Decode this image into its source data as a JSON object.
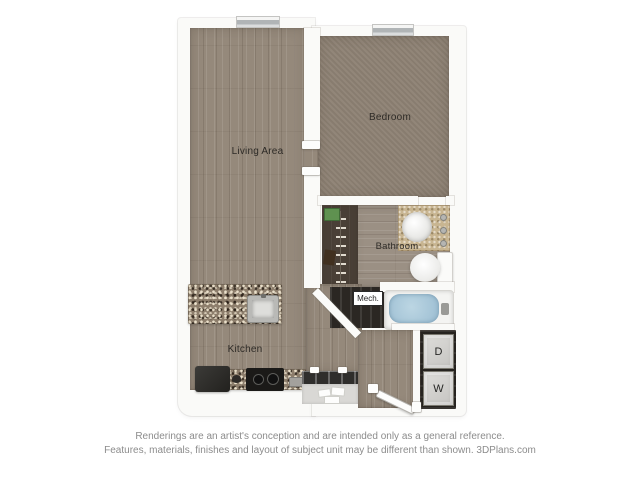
{
  "plan": {
    "rooms": {
      "living": {
        "label": "Living Area"
      },
      "bedroom": {
        "label": "Bedroom"
      },
      "bathroom": {
        "label": "Bathroom"
      },
      "kitchen": {
        "label": "Kitchen"
      },
      "mech": {
        "label": "Mech."
      }
    },
    "laundry": {
      "dryer": {
        "label": "D"
      },
      "washer": {
        "label": "W"
      }
    }
  },
  "footer": {
    "line1": "Renderings are an artist's conception and are intended only as a general reference.",
    "line2": "Features, materials, finishes and layout of subject unit may be different than shown. 3DPlans.com"
  },
  "colors": {
    "wood_floor": "#95897b",
    "carpet": "#8d8173",
    "closet_floor": "#4a4037",
    "granite": "#8d7e6c",
    "vanity_counter": "#c8b591",
    "tub_water": "#a3c3d6",
    "balcony_floor": "#d9d8d5",
    "appliance_dark": "#2c2a27",
    "wall": "#fafaf8",
    "window_glass": "#b0b4b6",
    "label_text": "#2d2a26",
    "footer_text": "#8c8c8c"
  }
}
